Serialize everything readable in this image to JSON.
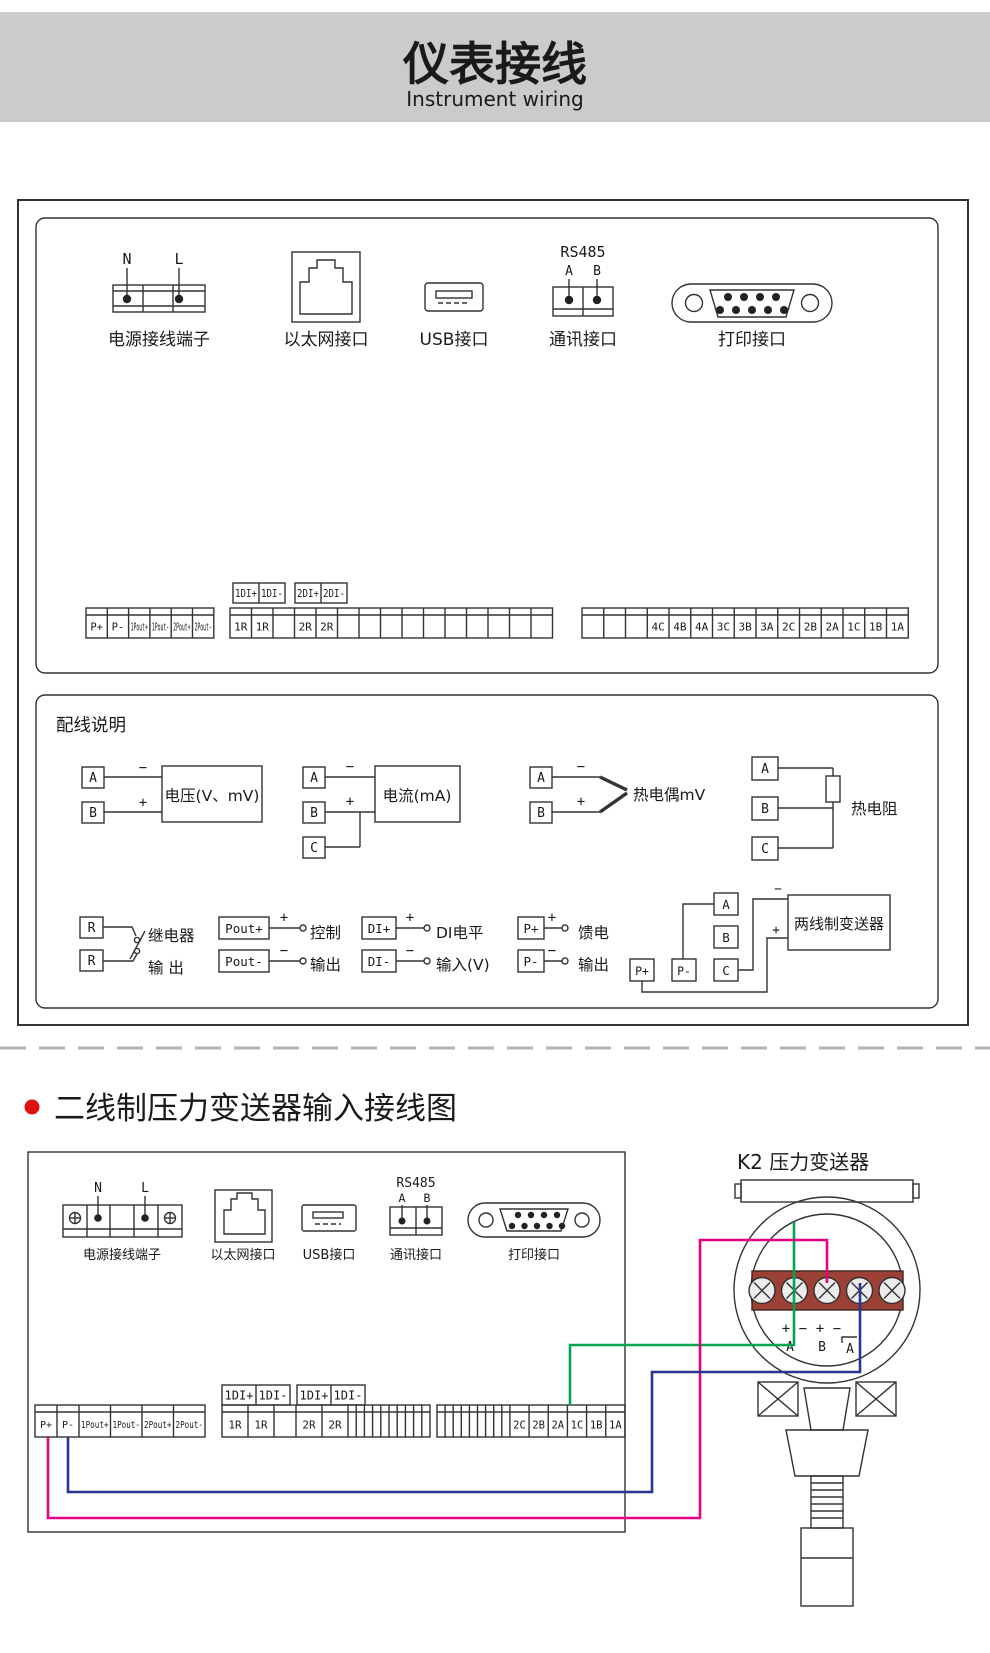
{
  "colors": {
    "header_band": "#cbcbcb",
    "bullet": "#dd1111",
    "terminal_band": "#9c4136",
    "wire_green": "#00a551",
    "wire_magenta": "#e60082",
    "wire_blue": "#283593",
    "line": "#333333"
  },
  "header": {
    "title": "仪表接线",
    "subtitle": "Instrument wiring"
  },
  "panel_top": {
    "power": {
      "label": "电源接线端子",
      "n": "N",
      "l": "L"
    },
    "ethernet": {
      "label": "以太网接口"
    },
    "usb": {
      "label": "USB接口"
    },
    "comm": {
      "label": "通讯接口",
      "protocol": "RS485",
      "a": "A",
      "b": "B"
    },
    "printer": {
      "label": "打印接口"
    },
    "di_pair1": [
      "1DI+",
      "1DI-"
    ],
    "di_pair2": [
      "2DI+",
      "2DI-"
    ],
    "strip_left": [
      "P+",
      "P-",
      "1Pout+",
      "1Pout-",
      "2Pout+",
      "2Pout-"
    ],
    "strip_mid": [
      "1R",
      "1R",
      "",
      "2R",
      "2R",
      "",
      "",
      "",
      "",
      "",
      "",
      "",
      "",
      "",
      ""
    ],
    "strip_right": [
      "",
      "",
      "",
      "4C",
      "4B",
      "4A",
      "3C",
      "3B",
      "3A",
      "2C",
      "2B",
      "2A",
      "1C",
      "1B",
      "1A"
    ]
  },
  "wiring_guide": {
    "title": "配线说明",
    "voltage": {
      "a": "A",
      "b": "B",
      "minus": "−",
      "plus": "+",
      "label": "电压(V、mV)"
    },
    "current": {
      "a": "A",
      "b": "B",
      "c": "C",
      "minus": "−",
      "plus": "+",
      "label": "电流(mA)"
    },
    "thermocouple": {
      "a": "A",
      "b": "B",
      "minus": "−",
      "plus": "+",
      "label": "热电偶mV"
    },
    "rtd": {
      "a": "A",
      "b": "B",
      "c": "C",
      "label": "热电阻"
    },
    "relay": {
      "r1": "R",
      "r2": "R",
      "label1": "继电器",
      "label2": "输  出"
    },
    "control": {
      "t1": "Pout+",
      "t2": "Pout-",
      "plus": "+",
      "minus": "−",
      "label1": "控制",
      "label2": "输出"
    },
    "di": {
      "t1": "DI+",
      "t2": "DI-",
      "plus": "+",
      "minus": "−",
      "label1": "DI电平",
      "label2": "输入(V)"
    },
    "feed": {
      "t1": "P+",
      "t2": "P-",
      "plus": "+",
      "minus": "−",
      "label1": "馈电",
      "label2": "输出"
    },
    "two_wire": {
      "a": "A",
      "b": "B",
      "c": "C",
      "p1": "P+",
      "p2": "P-",
      "minus": "−",
      "plus": "+",
      "label": "两线制变送器"
    }
  },
  "section2": {
    "title": "二线制压力变送器输入接线图"
  },
  "panel_bottom": {
    "power": {
      "label": "电源接线端子",
      "n": "N",
      "l": "L"
    },
    "ethernet": {
      "label": "以太网接口"
    },
    "usb": {
      "label": "USB接口"
    },
    "comm": {
      "label": "通讯接口",
      "protocol": "RS485",
      "a": "A",
      "b": "B"
    },
    "printer": {
      "label": "打印接口"
    },
    "di_pair1": [
      "1DI+",
      "1DI-"
    ],
    "di_pair2": [
      "1DI+",
      "1DI-"
    ],
    "strip_left": [
      "P+",
      "P-",
      "1Pout+",
      "1Pout-",
      "2Pout+",
      "2Pout-"
    ],
    "strip_mid": [
      "1R",
      "1R",
      "",
      "2R",
      "2R",
      "",
      "",
      "",
      "",
      "",
      "",
      "",
      "",
      "",
      ""
    ],
    "strip_right": [
      "",
      "",
      "",
      "",
      "",
      "",
      "",
      "",
      "",
      "2C",
      "2B",
      "2A",
      "1C",
      "1B",
      "1A"
    ]
  },
  "transmitter": {
    "title": "K2 压力变送器",
    "signs": [
      "+",
      "−",
      "+",
      "−"
    ],
    "letters": [
      "A",
      "B",
      "A"
    ]
  }
}
